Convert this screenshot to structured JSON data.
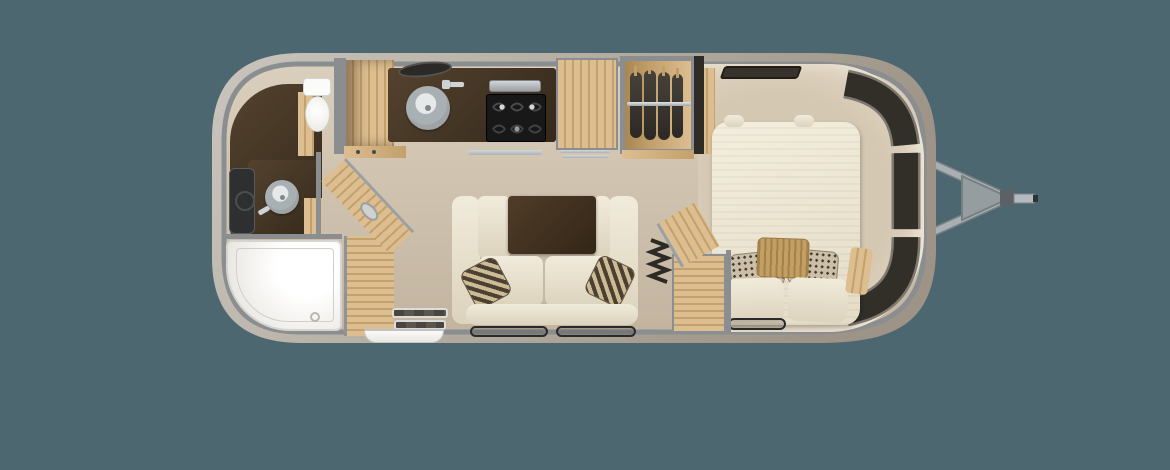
{
  "image": {
    "description": "Top-down 3D rendered floor plan of a single-axle travel trailer with rounded silver shell; rear bathroom at left, galley kitchen and wardrobe at center, sofa lounge at bottom center, front bedroom with bed at right, A-frame tow hitch extending from the right end",
    "orientation": "hitch-right"
  },
  "colors": {
    "bg": "#4d6770",
    "shellLight": "#c9c5bd",
    "shellMid": "#b2aa9e",
    "shellDark": "#9d9487",
    "wall": "#8a8e91",
    "floorTop": "#dacfbd",
    "floorBottom": "#c2b49f",
    "bedfloor": "#d5c8b3",
    "bedglow": "#e2d7c4",
    "woodLight": "#dcbe91",
    "woodMid": "#c3a06c",
    "woodDark": "#a98751",
    "darkCounter": "#54422e",
    "darkCounter2": "#34291b",
    "cream": "#f1ebdb",
    "creamShade": "#dcd3bd",
    "tableBrown": "#503c28",
    "metal": "#a9b0b4",
    "metalDark": "#787f83",
    "windowDark": "#322e28",
    "windowRim": "#7e7970",
    "patternBase": "#cbbfa8",
    "patternDark": "#433a2e",
    "accentTan": "#c49f63",
    "matBorder": "#2a2a2a",
    "accordion": "#2d2a26",
    "mirror": "#2d2f31"
  },
  "rooms": {
    "bathroom": {
      "label": "Rear wet bath",
      "features": [
        "corner shower",
        "toilet",
        "curved vanity with round sink",
        "mirror cabinet",
        "wood pocket area",
        "open wood door"
      ]
    },
    "kitchen": {
      "label": "Galley kitchen",
      "features": [
        "round stainless sink",
        "faucet",
        "vent",
        "three-burner cooktop",
        "silver tray",
        "wood-front refrigerator",
        "upper cabinet",
        "towel bar"
      ]
    },
    "wardrobe": {
      "label": "Wardrobe closet",
      "features": [
        "hanging rod",
        "four garments on hangers"
      ]
    },
    "living": {
      "label": "Sofa lounge",
      "features": [
        "cream sofa with two arms",
        "dark ottoman table",
        "two check throw pillows",
        "two floor mats",
        "entry treads",
        "exterior entry step"
      ]
    },
    "bedroom": {
      "label": "Front bedroom",
      "features": [
        "bed with cream mattress",
        "two speckled pillows",
        "two cream pillows",
        "tan accent pillow",
        "nightstand with open lid",
        "accordion divider",
        "bedside chest",
        "roof vent",
        "wraparound front windows",
        "floor mat"
      ]
    }
  },
  "hitch": {
    "label": "A-frame tongue and coupler",
    "parts": [
      "upper beam",
      "lower beam",
      "triangular plate",
      "coupler",
      "ball mount bar"
    ]
  }
}
